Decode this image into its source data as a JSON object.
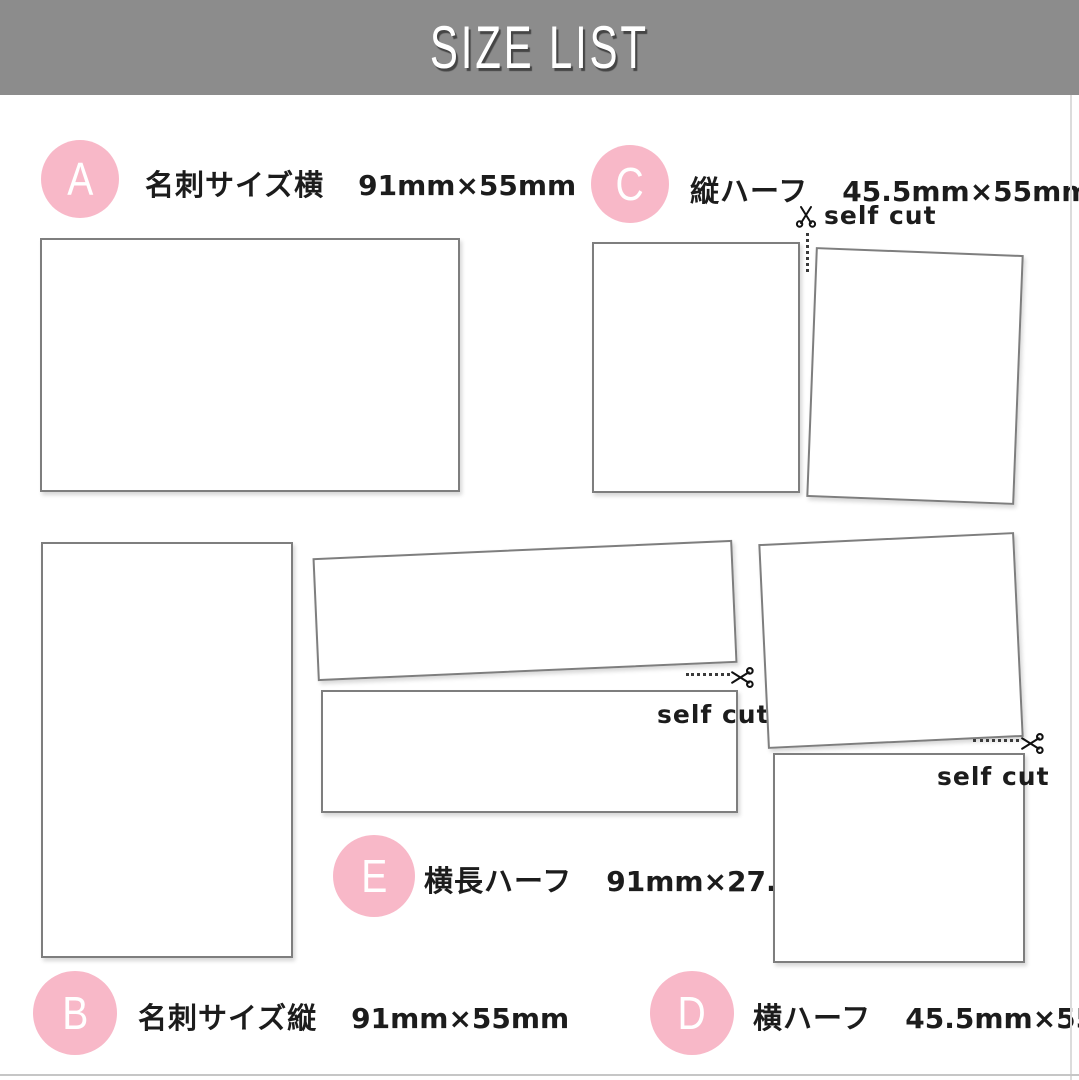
{
  "header": {
    "title": "SIZE LIST"
  },
  "colors": {
    "header_bg": "#8c8c8c",
    "accent_pink": "#f8b8c8",
    "card_border": "#7e7e7e",
    "text": "#1c1c1c"
  },
  "sections": {
    "A": {
      "letter": "A",
      "name": "名刺サイズ横",
      "size": "91mm×55mm"
    },
    "B": {
      "letter": "B",
      "name": "名刺サイズ縦",
      "size": "91mm×55mm"
    },
    "C": {
      "letter": "C",
      "name": "縦ハーフ",
      "size": "45.5mm×55mm",
      "cut_label": "self cut"
    },
    "D": {
      "letter": "D",
      "name": "横ハーフ",
      "size": "45.5mm×55mm",
      "cut_label": "self cut"
    },
    "E": {
      "letter": "E",
      "name": "横長ハーフ",
      "size": "91mm×27.5mm",
      "cut_label": "self cut"
    }
  }
}
